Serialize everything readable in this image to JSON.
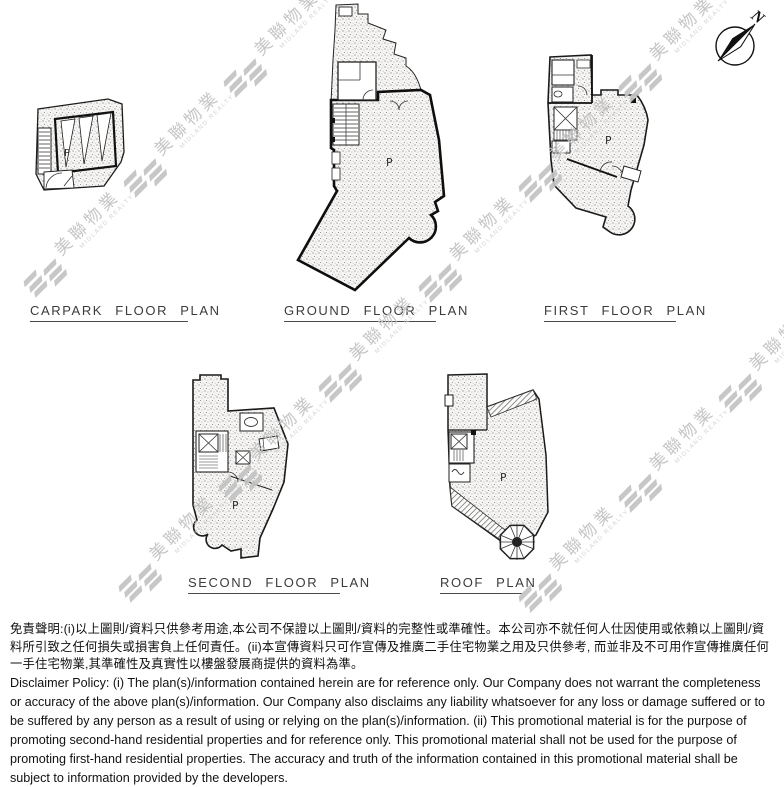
{
  "compass": {
    "label": "N"
  },
  "plans": [
    {
      "id": "carpark",
      "title": "CARPARK FLOOR PLAN",
      "area_label": "P"
    },
    {
      "id": "ground",
      "title": "GROUND FLOOR PLAN",
      "area_label": "P"
    },
    {
      "id": "first",
      "title": "FIRST FLOOR PLAN",
      "area_label": "P"
    },
    {
      "id": "second",
      "title": "SECOND FLOOR PLAN",
      "area_label": "P"
    },
    {
      "id": "roof",
      "title": "ROOF PLAN",
      "area_label": "P"
    }
  ],
  "watermark": {
    "text": "美聯物業",
    "subtext": "MIDLAND REALTY",
    "color": "#c3c3c3"
  },
  "disclaimer": {
    "zh": "免責聲明:(i)以上圖則/資料只供參考用途,本公司不保證以上圖則/資料的完整性或準確性。本公司亦不就任何人仕因使用或依賴以上圖則/資料所引致之任何損失或損害負上任何責任。(ii)本宣傳資料只可作宣傳及推廣二手住宅物業之用及只供參考, 而並非及不可用作宣傳推廣任何一手住宅物業,其準確性及真實性以樓盤發展商提供的資料為準。",
    "en": "Disclaimer Policy: (i) The plan(s)/information contained herein are for reference only. Our Company does not warrant the completeness or accuracy of the above plan(s)/information. Our Company also disclaims any liability whatsoever for any loss or damage suffered or to be suffered by any person as a result of using or relying on the plan(s)/information. (ii) This promotional material is for the purpose of promoting second-hand residential properties and for reference only. This promotional material shall not be used for the purpose of promoting first-hand residential properties. The accuracy and truth of the information contained in this promotional material shall be subject to information provided by the developers."
  }
}
